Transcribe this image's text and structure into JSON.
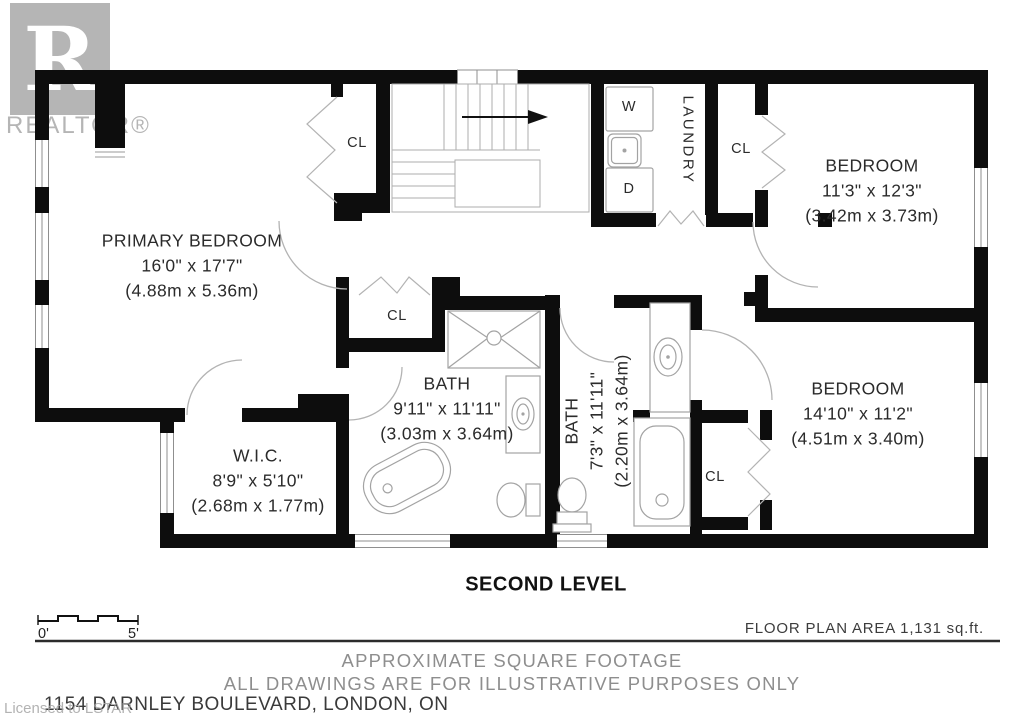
{
  "branding": {
    "logo_letter": "R",
    "logo_text": "REALTOR®",
    "license_note": "Licensed to LSTAR"
  },
  "plan": {
    "level_title": "SECOND LEVEL",
    "rooms": [
      {
        "name": "PRIMARY BEDROOM",
        "dims_imperial": "16'0\" x 17'7\"",
        "dims_metric": "(4.88m x 5.36m)"
      },
      {
        "name": "BEDROOM",
        "dims_imperial": "11'3\" x 12'3\"",
        "dims_metric": "(3.42m x 3.73m)"
      },
      {
        "name": "BEDROOM",
        "dims_imperial": "14'10\" x 11'2\"",
        "dims_metric": "(4.51m x 3.40m)"
      },
      {
        "name": "W.I.C.",
        "dims_imperial": "8'9\" x 5'10\"",
        "dims_metric": "(2.68m x 1.77m)"
      },
      {
        "name": "BATH",
        "dims_imperial": "9'11\" x 11'11\"",
        "dims_metric": "(3.03m x 3.64m)"
      },
      {
        "name": "BATH",
        "dims_imperial": "7'3\" x 11'11\"",
        "dims_metric": "(2.20m x 3.64m)"
      }
    ],
    "labels": {
      "laundry": "LAUNDRY",
      "washer": "W",
      "dryer": "D",
      "closet": "CL"
    },
    "scale": {
      "start": "0'",
      "end": "5'"
    }
  },
  "footer": {
    "area_note": "FLOOR PLAN AREA 1,131 sq.ft.",
    "disclaimer_line1": "APPROXIMATE SQUARE FOOTAGE",
    "disclaimer_line2": "ALL DRAWINGS ARE FOR ILLUSTRATIVE PURPOSES ONLY",
    "address": "1154 DARNLEY BOULEVARD, LONDON, ON"
  },
  "colors": {
    "wall": "#0d0d0d",
    "thin_line": "#b3b3b3",
    "text": "#2b2b2b",
    "muted_text": "#8e8e8e",
    "logo_gray": "#b5b5b5"
  }
}
